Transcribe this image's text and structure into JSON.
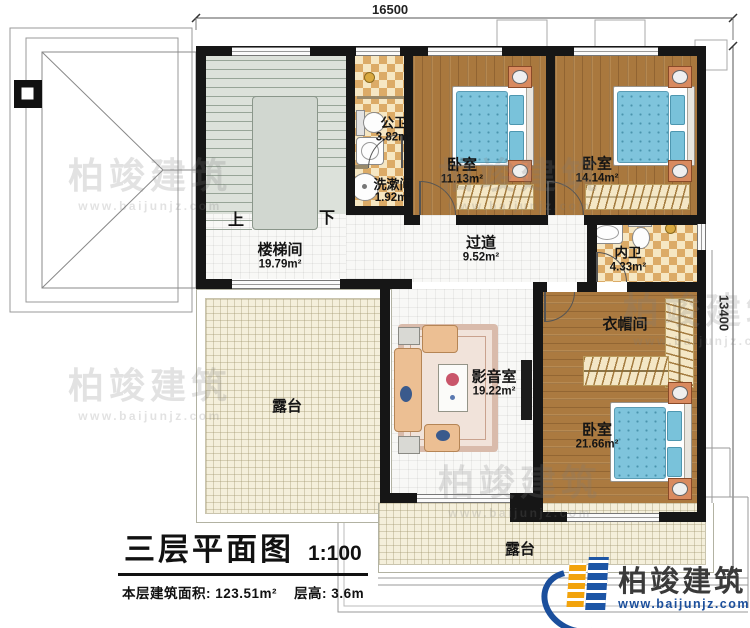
{
  "dimensions": {
    "top": "16500",
    "right": "13400"
  },
  "rooms": {
    "stairwell": {
      "name": "楼梯间",
      "area": "19.79m²"
    },
    "public_bath": {
      "name": "公卫",
      "area": "3.82m²"
    },
    "washroom": {
      "name": "洗漱间",
      "area": "1.92m²"
    },
    "bedroom1": {
      "name": "卧室",
      "area": "11.13m²"
    },
    "bedroom2": {
      "name": "卧室",
      "area": "14.14m²"
    },
    "ensuite_bath": {
      "name": "内卫",
      "area": "4.33m²"
    },
    "cloakroom": {
      "name": "衣帽间"
    },
    "bedroom3": {
      "name": "卧室",
      "area": "21.66m²"
    },
    "hallway": {
      "name": "过道",
      "area": "9.52m²"
    },
    "media_room": {
      "name": "影音室",
      "area": "19.22m²"
    },
    "terrace_left": {
      "name": "露台"
    },
    "terrace_bottom": {
      "name": "露台"
    }
  },
  "stairs": {
    "up": "上",
    "down": "下"
  },
  "title": {
    "main": "三层平面图",
    "scale": "1:100",
    "area_line": "本层建筑面积: 123.51m²",
    "height_line": "层高: 3.6m"
  },
  "logo": {
    "name": "柏竣建筑",
    "url": "www.baijunjz.com"
  },
  "watermark": {
    "name": "柏竣建筑",
    "url": "www.baijunjz.com"
  },
  "colors": {
    "wall": "#161616",
    "wood_floor": "#a9783e",
    "checker_tile": "#dcab67",
    "terrace": "#f4efdb",
    "bed": "#7fc4dc",
    "nightstand": "#d98a5f",
    "logo_blue": "#1b4f9c",
    "logo_yellow": "#f2a30c"
  }
}
